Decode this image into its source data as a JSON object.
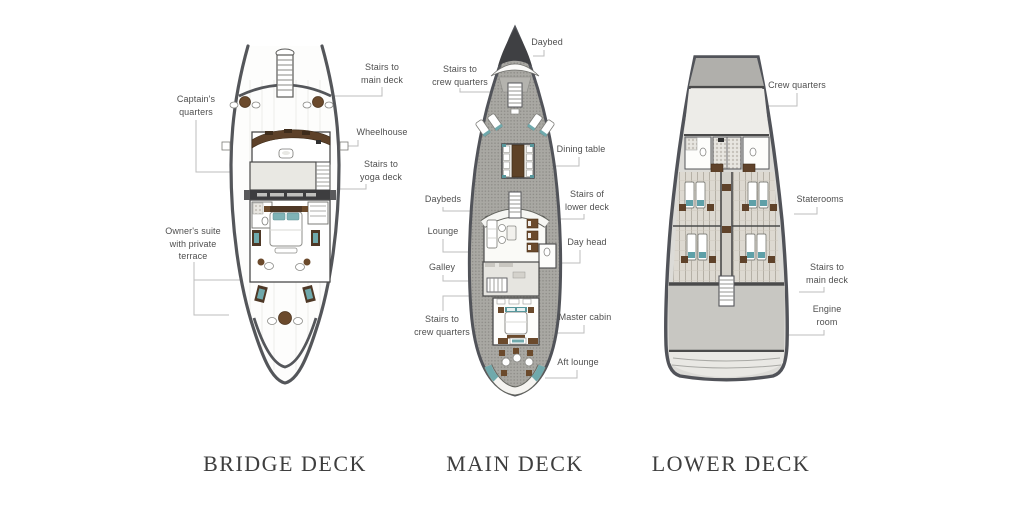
{
  "page": {
    "background": "#ffffff",
    "type_note": "Yacht deck plans infographic"
  },
  "colors": {
    "hull_outline": "#54565a",
    "deck_texture": "#a9a8a3",
    "room_light": "#e9e8e3",
    "accent_brown": "#6b4a2c",
    "accent_dark_brown": "#4e3826",
    "accent_teal": "#6fa9ac",
    "label_text": "#4f4f4f",
    "title_text": "#3e3e3e",
    "leader_line": "#bdbdbd"
  },
  "decks": {
    "bridge": {
      "title": "BRIDGE DECK",
      "labels": {
        "stairs_main_deck": "Stairs to\nmain deck",
        "captains_quarters": "Captain's\nquarters",
        "wheelhouse": "Wheelhouse",
        "stairs_yoga_deck": "Stairs to\nyoga deck",
        "owners_suite": "Owner's suite\nwith private\nterrace"
      }
    },
    "main": {
      "title": "MAIN DECK",
      "labels": {
        "daybed": "Daybed",
        "stairs_crew_quarters_top": "Stairs to\ncrew quarters",
        "dining_table": "Dining table",
        "daybeds": "Daybeds",
        "stairs_lower_deck": "Stairs of\nlower deck",
        "lounge": "Lounge",
        "day_head": "Day head",
        "galley": "Galley",
        "stairs_crew_quarters_bottom": "Stairs to\ncrew quarters",
        "master_cabin": "Master cabin",
        "aft_lounge": "Aft lounge"
      }
    },
    "lower": {
      "title": "LOWER DECK",
      "labels": {
        "crew_quarters": "Crew quarters",
        "staterooms": "Staterooms",
        "stairs_main_deck": "Stairs to\nmain deck",
        "engine_room": "Engine\nroom"
      }
    }
  }
}
